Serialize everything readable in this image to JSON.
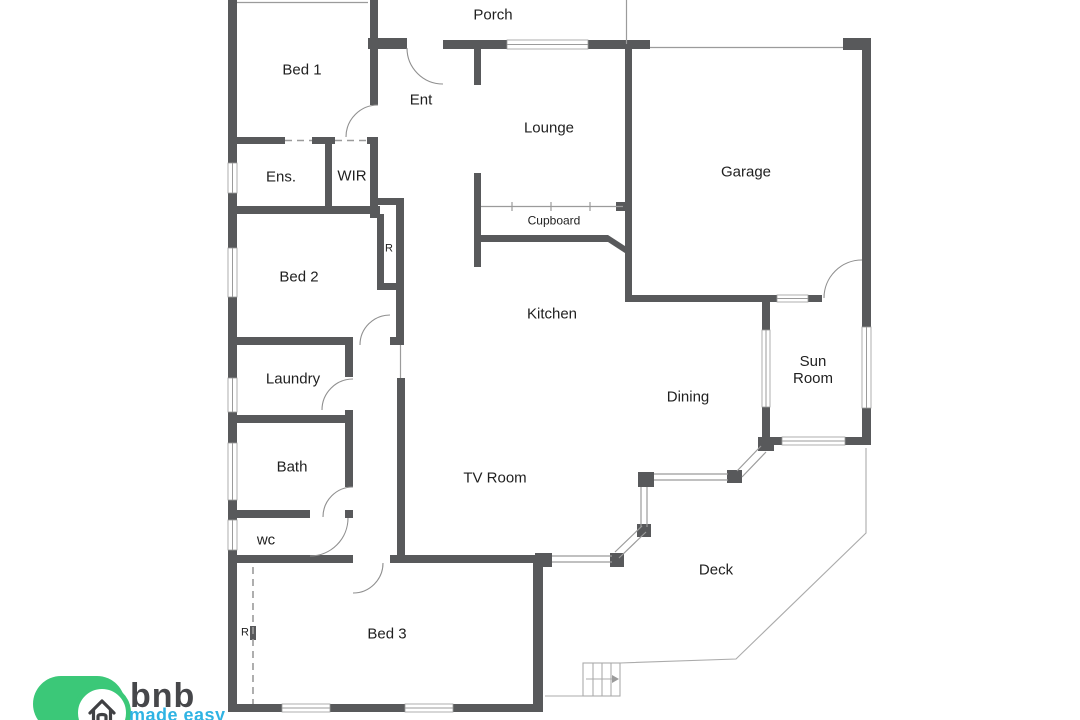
{
  "colors": {
    "background": "#ffffff",
    "wall": "#58595b",
    "thin_line": "#9b9b9b",
    "door_arc": "#8f8f8f",
    "label": "#1f1f1f",
    "logo_green": "#3bc878",
    "logo_text": "#46474a",
    "logo_tagline": "#2fb3e3"
  },
  "rooms": {
    "porch": "Porch",
    "bed1": "Bed 1",
    "ent": "Ent",
    "lounge": "Lounge",
    "garage": "Garage",
    "ens": "Ens.",
    "wir": "WIR",
    "robe_top": "R",
    "bed2": "Bed 2",
    "cupboard": "Cupboard",
    "kitchen": "Kitchen",
    "sun_room": "Sun Room",
    "laundry": "Laundry",
    "dining": "Dining",
    "bath": "Bath",
    "tv_room": "TV Room",
    "wc": "wc",
    "deck": "Deck",
    "bed3": "Bed 3",
    "robe_bed3": "R"
  },
  "logo": {
    "brand": "bnb",
    "tagline": "made easy"
  }
}
